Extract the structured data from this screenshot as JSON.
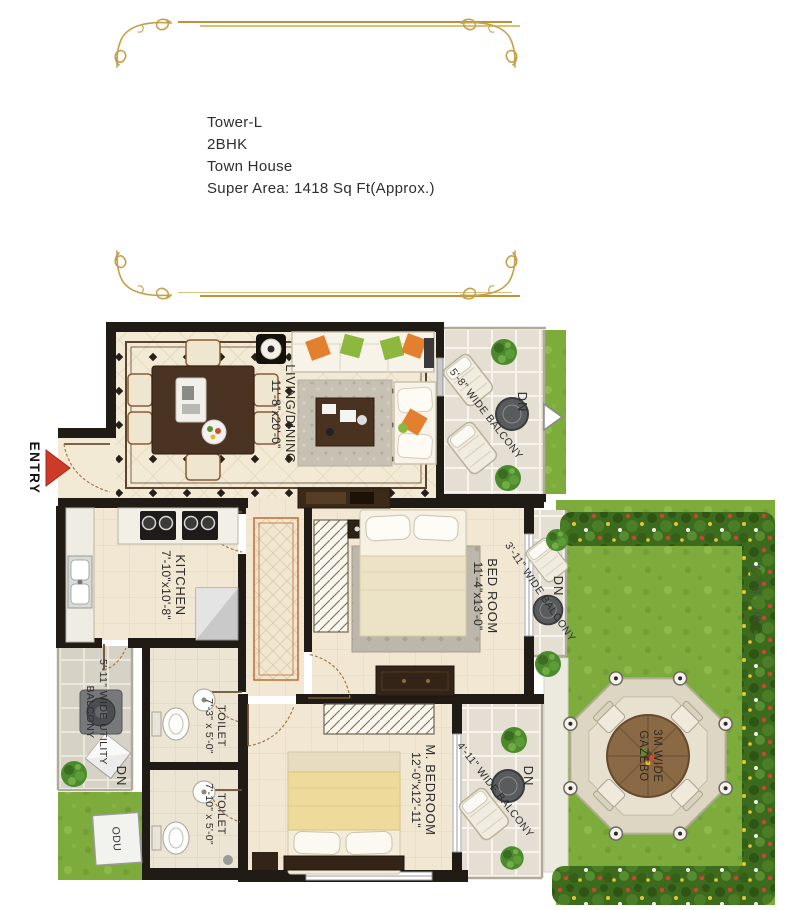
{
  "header": {
    "lines": [
      "Tower-L",
      "2BHK",
      "Town House",
      "Super Area: 1418 Sq Ft(Approx.)"
    ]
  },
  "plan": {
    "entry": "ENTRY",
    "dn": "DN",
    "living": {
      "name": "LIVING/DINING",
      "size": "11'-8\"x20'-0\""
    },
    "kitchen": {
      "name": "KITCHEN",
      "size": "7'-10\"x10'-8\""
    },
    "bedroom": {
      "name": "BED ROOM",
      "size": "11'-4\"x13'-0\""
    },
    "master": {
      "name": "M. BEDROOM",
      "size": "12'-0\"x12'-11\""
    },
    "toilet1": {
      "name": "TOILET",
      "size": "7'-3\" x 5'-0\""
    },
    "toilet2": {
      "name": "TOILET",
      "size": "7'-10\" x 5'-0\""
    },
    "balcony_top": "5'-8\" WIDE BALCONY",
    "balcony_mid": "3'-11\" WIDE BALCONY",
    "balcony_bottom": "4'-11\" WIDE BALCONY",
    "utility": {
      "line1": "5'-11\" WIDE UTILITY",
      "line2": "BALCONY"
    },
    "gazebo": {
      "line1": "3M WIDE",
      "line2": "GAZEBO"
    },
    "odu": "ODU",
    "railing": "M.S RAILING"
  },
  "colors": {
    "frame_gold": "#bd9336",
    "wall_black": "#201b15",
    "lawn_green": "#7dac3c",
    "hedge_green": "#3c6b1d",
    "entry_arrow_red": "#cd3a27",
    "floor_cream": "#f1e7d2"
  }
}
